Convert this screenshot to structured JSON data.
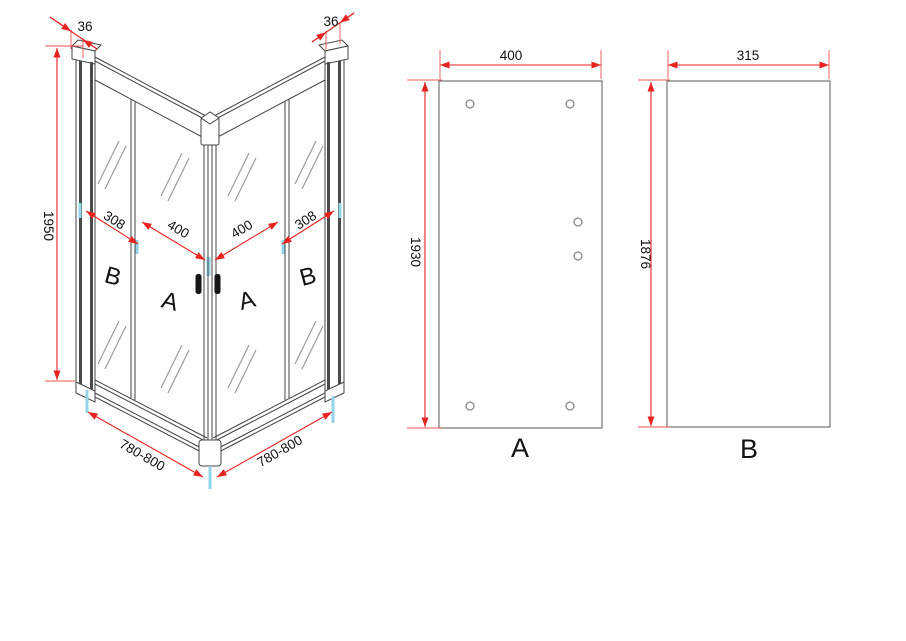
{
  "drawing": {
    "type": "corner-shower-enclosure-technical-drawing",
    "corner_view": {
      "dim_profile_left": "36",
      "dim_profile_right": "36",
      "dim_height": "1950",
      "dim_fixed_left": "308",
      "dim_door_left": "400",
      "dim_door_right": "400",
      "dim_fixed_right": "308",
      "dim_width_left": "780-800",
      "dim_width_right": "780-800",
      "label_fixed_left": "B",
      "label_door_left": "A",
      "label_door_right": "A",
      "label_fixed_right": "B"
    },
    "door_panel_view": {
      "dim_width": "400",
      "dim_height": "1930",
      "label": "A"
    },
    "fixed_panel_view": {
      "dim_width": "315",
      "dim_height": "1876",
      "label": "B"
    },
    "colors": {
      "dimension_line": "#e8231f",
      "glass_edge_accent": "#93d4e6",
      "line_art": "#454545",
      "text": "#111111"
    }
  }
}
